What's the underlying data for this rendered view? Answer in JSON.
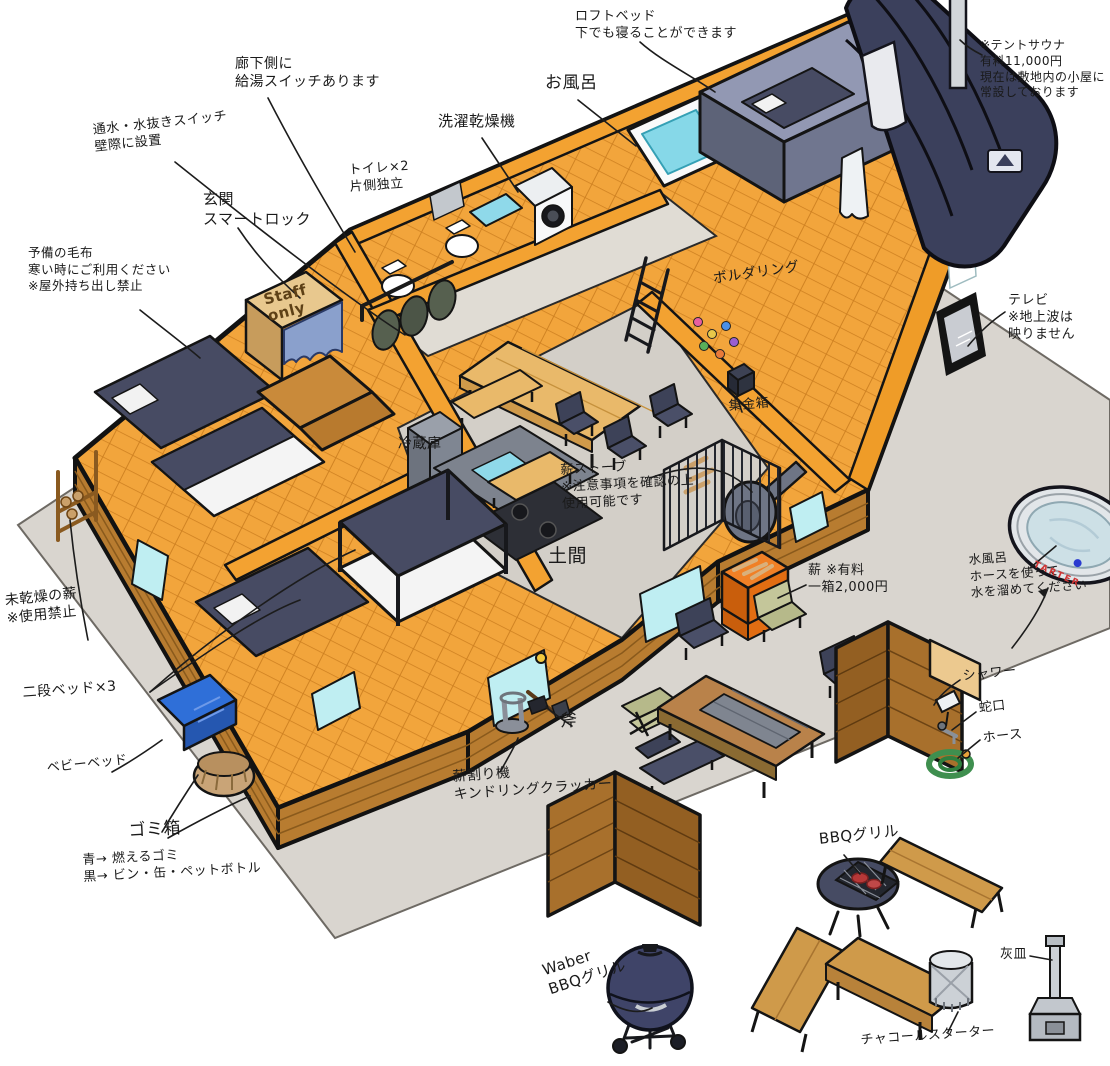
{
  "labels": {
    "loft_bed": "ロフトベッド\n下でも寝ることができます",
    "bath": "お風呂",
    "washer_dryer": "洗濯乾燥機",
    "toilets": "トイレ×2\n片側独立",
    "water_heater_switch": "廊下側に\n給湯スイッチあります",
    "water_drain_switch": "通水・水抜きスイッチ\n壁際に設置",
    "entrance": "玄関\nスマートロック",
    "spare_blankets": "予備の毛布\n寒い時にご利用ください\n※屋外持ち出し禁止",
    "tent_sauna": "※テントサウナ\n有料11,000円\n現在は敷地内の小屋に\n常設しております",
    "tv": "テレビ\n※地上波は\n映りません",
    "bouldering": "ボルダリング",
    "collection_box": "集金箱",
    "fridge": "冷蔵庫",
    "wood_stove": "薪ストーブ\n※注意事項を確認の上\n使用可能です",
    "doma": "土間",
    "firewood": "薪 ※有料\n一箱2,000円",
    "cold_bath": "水風呂\nホースを使って\n水を溜めてください",
    "shower": "シャワー",
    "faucet": "蛇口",
    "hose": "ホース",
    "wet_firewood": "未乾燥の薪\n※使用禁止",
    "bunk_beds": "二段ベッド×3",
    "baby_bed": "ベビーベッド",
    "trash": "ゴミ箱",
    "trash_rules": "青→ 燃えるゴミ\n黒→ ビン・缶・ペットボトル",
    "wood_splitter": "薪割り機\nキンドリングクラッカー",
    "axe": "斧",
    "bbq_grill": "BBQグリル",
    "weber_grill": "Waber\nBBQグリル",
    "ashtray": "灰皿",
    "charcoal_starter": "チャコールスターター",
    "staff_box": "Staff\nonly",
    "water_tank_brand": "TARTER"
  },
  "colors": {
    "wall_orange": "#f3a231",
    "floor_wood": "#f2a53c",
    "siding_brown": "#b87c30",
    "concrete_gray": "#d9d5cf",
    "navy": "#3f4468",
    "water_cyan": "#86d8e8",
    "window_cyan": "#bfeef2",
    "crate_orange": "#f08026",
    "baby_bed_blue": "#2f6fd8",
    "outline_black": "#141414"
  }
}
